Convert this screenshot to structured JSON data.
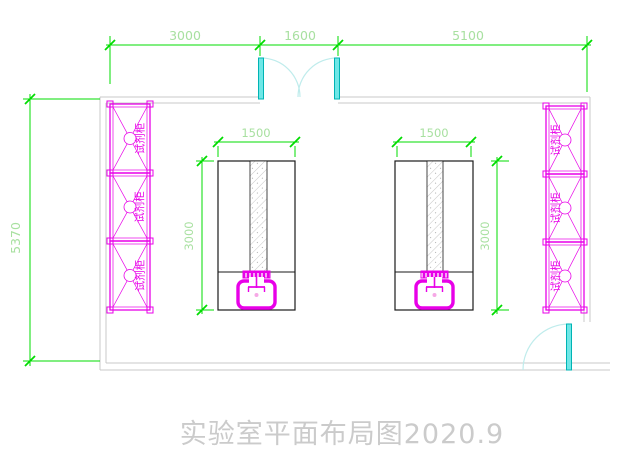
{
  "title": "实验室平面布局图2020.9",
  "dimensions": {
    "top": [
      {
        "name": "left-span",
        "label": "3000"
      },
      {
        "name": "door-span",
        "label": "1600"
      },
      {
        "name": "right-span",
        "label": "5100"
      }
    ],
    "left_wall": {
      "label": "5370"
    },
    "island_left": {
      "width": "1500",
      "depth": "3000"
    },
    "island_right": {
      "width": "1500",
      "depth": "3000"
    }
  },
  "cabinets": {
    "label": "试剂柜",
    "left_column_units": 3,
    "right_column_units": 3
  },
  "symbols": {
    "double_door": "double-swing-door-icon",
    "single_door": "single-swing-door-icon",
    "sink": "sink-icon",
    "cabinet_unit": "reagent-cabinet-icon",
    "bench_strip": "hatched-strip"
  },
  "colors": {
    "dimension_line": "#00dc00",
    "dimension_text": "#a8e0a0",
    "cabinet_magenta": "#e800e8",
    "door_cyan": "#6fe7e7",
    "door_arc": "#bfecec",
    "wall_gray": "#c8c8c8",
    "island_outline": "#1a1a1a",
    "title_gray": "#cbcbcb"
  }
}
